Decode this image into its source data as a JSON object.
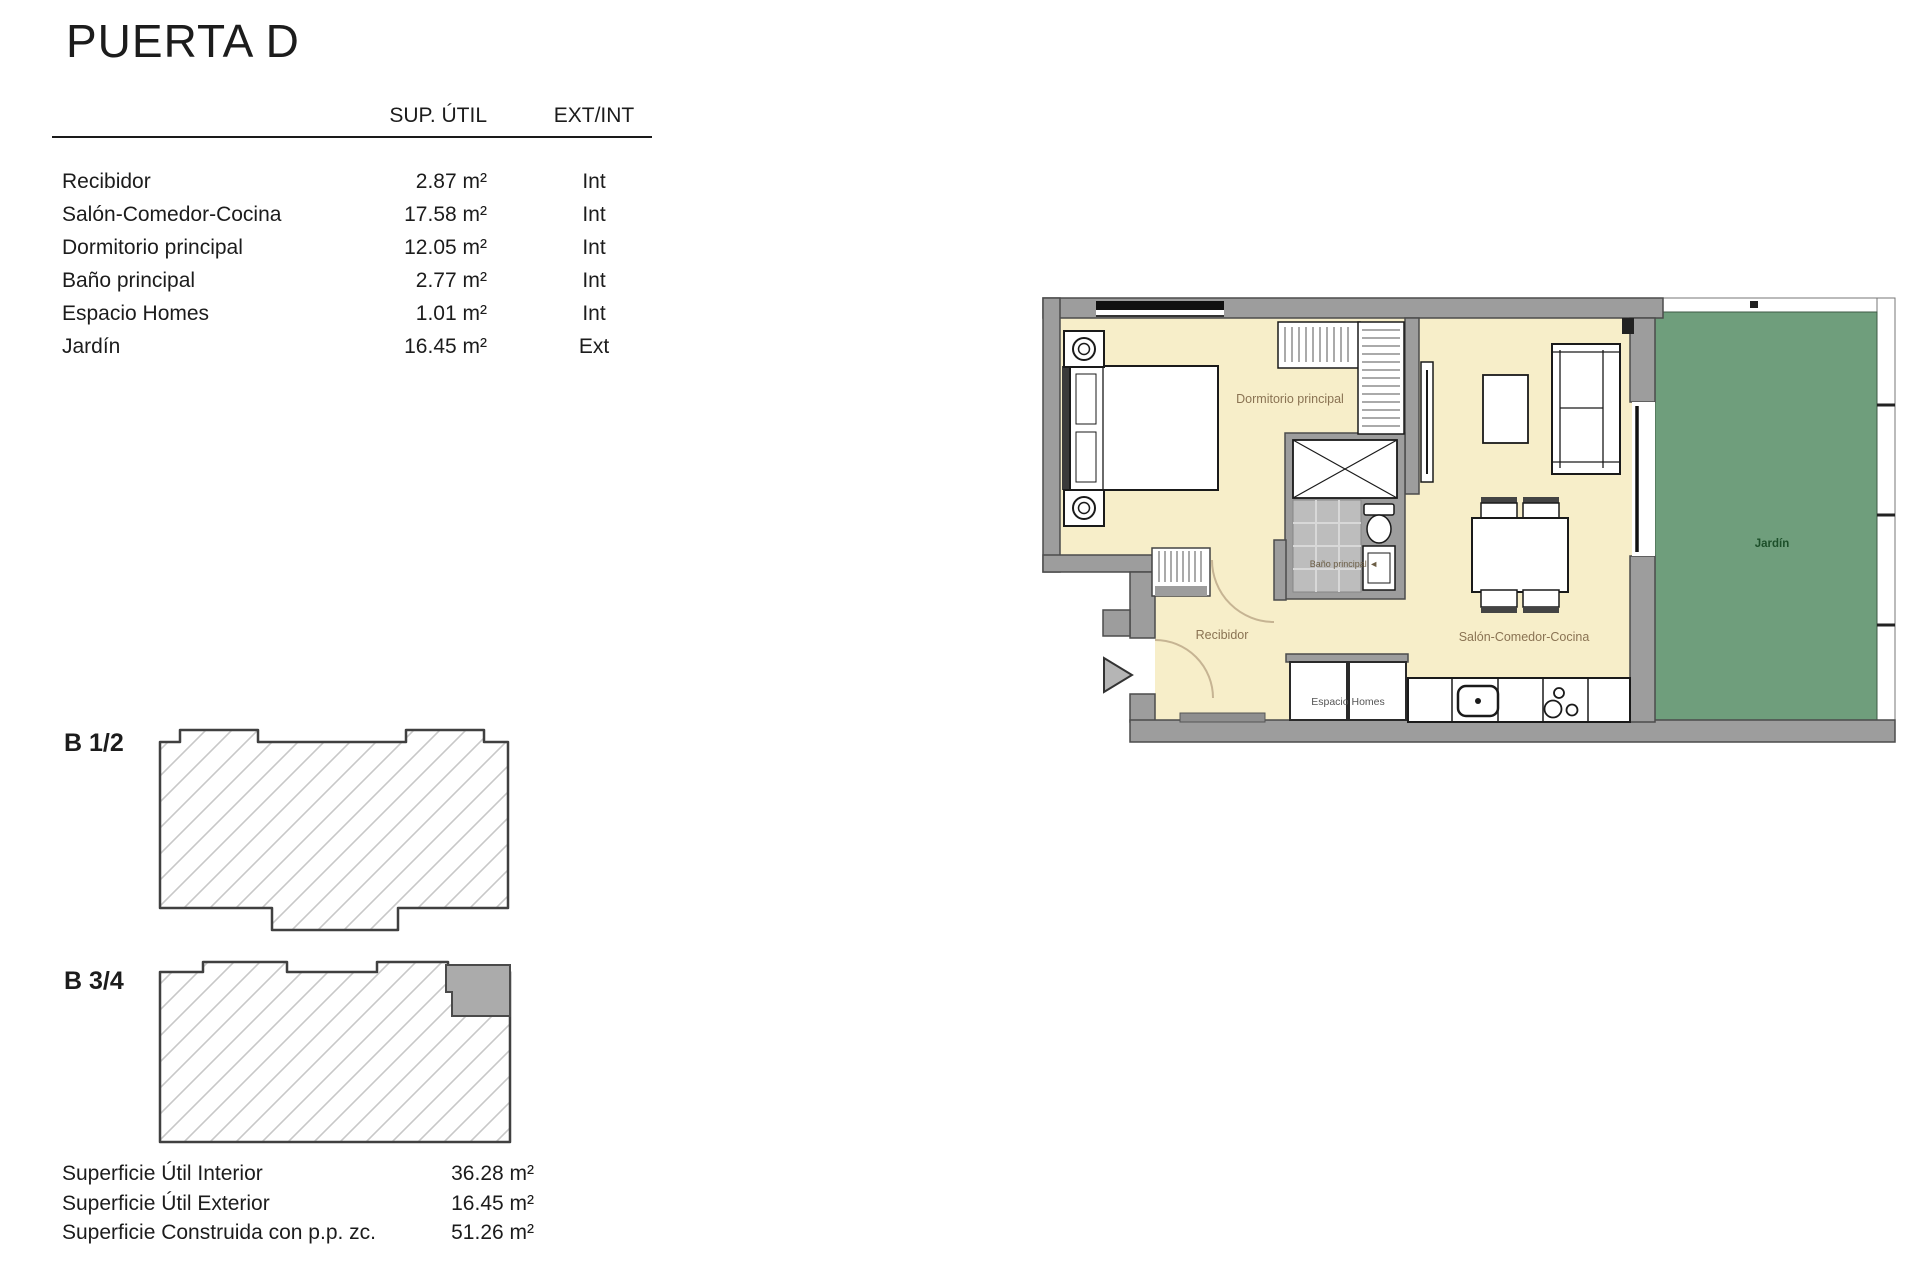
{
  "title": "PUERTA D",
  "table": {
    "col_area": "SUP. ÚTIL",
    "col_type": "EXT/INT",
    "rows": [
      {
        "name": "Recibidor",
        "area": "2.87 m²",
        "type": "Int"
      },
      {
        "name": "Salón-Comedor-Cocina",
        "area": "17.58 m²",
        "type": "Int"
      },
      {
        "name": "Dormitorio principal",
        "area": "12.05 m²",
        "type": "Int"
      },
      {
        "name": "Baño principal",
        "area": "2.77 m²",
        "type": "Int"
      },
      {
        "name": "Espacio Homes",
        "area": "1.01 m²",
        "type": "Int"
      },
      {
        "name": "Jardín",
        "area": "16.45 m²",
        "type": "Ext"
      }
    ]
  },
  "blocks": {
    "b12": "B 1/2",
    "b34": "B 3/4"
  },
  "summary": [
    {
      "label": "Superficie Útil Interior",
      "value": "36.28 m²"
    },
    {
      "label": "Superficie Útil Exterior",
      "value": "16.45 m²"
    },
    {
      "label": "Superficie Construida con p.p. zc.",
      "value": "51.26 m²"
    }
  ],
  "floorplan": {
    "labels": {
      "dormitorio": "Dormitorio principal",
      "bano": "Baño principal ◄",
      "recibidor": "Recibidor",
      "salon": "Salón-Comedor-Cocina",
      "espacio": "Espacio Homes",
      "jardin": "Jardín"
    },
    "colors": {
      "floor": "#f7eec9",
      "wall": "#9d9d9d",
      "wall_outline": "#4c4c4c",
      "garden": "#6f9e7c",
      "room_label": "#8a7353",
      "garden_label": "#1d4f2a"
    }
  }
}
